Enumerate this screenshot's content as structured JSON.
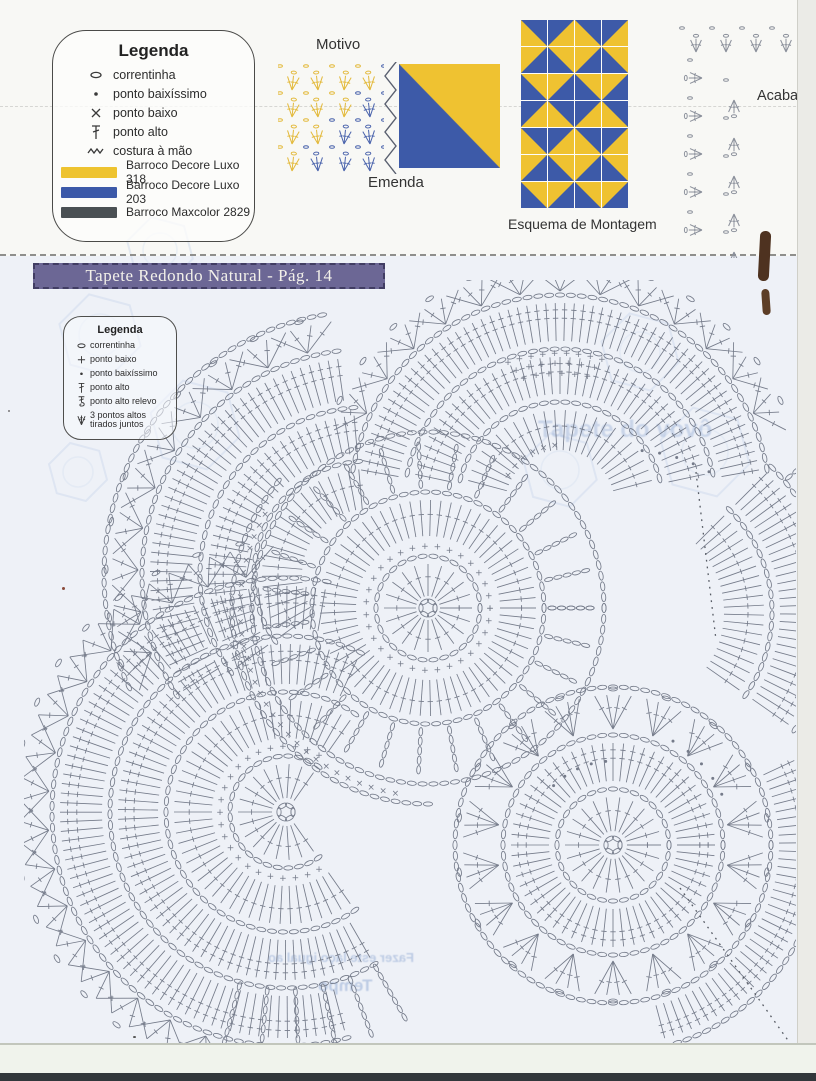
{
  "banner": {
    "title": "Tapete Redondo Natural - Pág. 14",
    "bg": "#6c6795"
  },
  "section_labels": {
    "motivo": "Motivo",
    "emenda": "Emenda",
    "esquema": "Esquema de Montagem",
    "acabamento": "Acabam"
  },
  "legend1": {
    "title": "Legenda",
    "items": [
      {
        "symbol": "chain",
        "label": "correntinha"
      },
      {
        "symbol": "slip-stitch",
        "label": "ponto baixíssimo"
      },
      {
        "symbol": "single-crochet-x",
        "label": "ponto baixo"
      },
      {
        "symbol": "double-crochet",
        "label": "ponto alto"
      },
      {
        "symbol": "hand-seam",
        "label": "costura à mão"
      }
    ],
    "yarns": [
      {
        "color": "#eec32f",
        "label": "Barroco Decore Luxo 318"
      },
      {
        "color": "#3c59a8",
        "label": "Barroco Decore Luxo 203"
      },
      {
        "color": "#4a5053",
        "label": "Barroco Maxcolor 2829"
      }
    ]
  },
  "legend2": {
    "title": "Legenda",
    "items": [
      {
        "symbol": "chain",
        "label": "correntinha"
      },
      {
        "symbol": "single-crochet-plus",
        "label": "ponto baixo"
      },
      {
        "symbol": "slip-stitch",
        "label": "ponto baixíssimo"
      },
      {
        "symbol": "double-crochet",
        "label": "ponto alto"
      },
      {
        "symbol": "double-crochet-relief",
        "label": "ponto alto relevo"
      },
      {
        "symbol": "3dc-together",
        "label": "3 pontos altos tirados juntos"
      }
    ]
  },
  "esquema": {
    "colors": {
      "yellow": "#efc231",
      "blue": "#3d5aa8"
    },
    "grid": [
      [
        "TR",
        "TL",
        "TR",
        "TL"
      ],
      [
        "BR",
        "BL",
        "BR",
        "BL"
      ],
      [
        "TRi",
        "TLi",
        "TRi",
        "TLi"
      ],
      [
        "BRi",
        "BLi",
        "BRi",
        "BLi"
      ],
      [
        "TR",
        "TL",
        "TR",
        "TL"
      ],
      [
        "BR",
        "BL",
        "BR",
        "BL"
      ],
      [
        "TRi",
        "TLi",
        "TRi",
        "TLi"
      ]
    ]
  },
  "motivo_chart": {
    "yellow": "#e3b93a",
    "blue": "#4a63ac",
    "rows": 4,
    "cols": 4
  },
  "emenda_square": {
    "top_right": "#efc231",
    "bottom_left": "#3d5aa8"
  },
  "ghost_texts": [
    {
      "text": "Tapete do vovô",
      "x": 538,
      "y": 416,
      "size": 24,
      "mirror": false,
      "opacity": 0.45
    },
    {
      "text": "Fazer este laço igual ao",
      "x": 268,
      "y": 950,
      "size": 13,
      "mirror": true,
      "opacity": 0.6
    },
    {
      "text": "Tempo",
      "x": 318,
      "y": 976,
      "size": 17,
      "mirror": true,
      "opacity": 0.6
    }
  ],
  "diagram": {
    "stroke": "#6a7180",
    "circles": [
      {
        "name": "bottom-right",
        "cx": 613,
        "cy": 845,
        "rings": [
          {
            "t": "ovals",
            "r": 7
          },
          {
            "t": "spokes",
            "r0": 14,
            "r1": 48,
            "ticks": 1
          },
          {
            "t": "ovals",
            "r": 56
          },
          {
            "t": "spokes",
            "r0": 64,
            "r1": 102,
            "ticks": 2
          },
          {
            "t": "ovals",
            "r": 110
          },
          {
            "t": "shells",
            "r0": 118,
            "r1": 150
          },
          {
            "t": "ovals",
            "r": 158
          },
          {
            "t": "spokes",
            "r0": 166,
            "r1": 200,
            "a0": -75,
            "a1": 25,
            "ticks": 2
          },
          {
            "t": "ovals",
            "r": 208,
            "a0": -75,
            "a1": 25
          },
          {
            "t": "dots",
            "r": 120,
            "a0": 25,
            "a1": 60
          },
          {
            "t": "dots",
            "r": 84,
            "a0": 95,
            "a1": 135
          }
        ]
      },
      {
        "name": "bottom-left",
        "cx": 286,
        "cy": 812,
        "rings": [
          {
            "t": "ovals",
            "r": 7
          },
          {
            "t": "spokes",
            "r0": 14,
            "r1": 48,
            "a0": 55,
            "a1": 305,
            "ticks": 1
          },
          {
            "t": "ovals",
            "r": 56,
            "a0": 55,
            "a1": 305
          },
          {
            "t": "plus",
            "r": 66,
            "a0": 60,
            "a1": 300
          },
          {
            "t": "spokes",
            "r0": 74,
            "r1": 112,
            "a0": 55,
            "a1": 305,
            "ticks": 1
          },
          {
            "t": "ovals",
            "r": 120,
            "a0": 55,
            "a1": 305
          },
          {
            "t": "spokes",
            "r0": 128,
            "r1": 168,
            "a0": 65,
            "a1": 300,
            "ticks": 2
          },
          {
            "t": "ovals",
            "r": 176,
            "a0": 65,
            "a1": 300
          },
          {
            "t": "spokes",
            "r0": 184,
            "r1": 226,
            "a0": 80,
            "a1": 285,
            "ticks": 2
          },
          {
            "t": "ovals",
            "r": 234,
            "a0": 80,
            "a1": 285
          },
          {
            "t": "shells",
            "r0": 240,
            "r1": 266,
            "a0": 95,
            "a1": 255
          },
          {
            "t": "chains",
            "r0": 180,
            "r1": 246,
            "a0": 255,
            "a1": 300
          }
        ]
      },
      {
        "name": "middle",
        "cx": 428,
        "cy": 608,
        "rings": [
          {
            "t": "ovals",
            "r": 7
          },
          {
            "t": "spokes",
            "r0": 12,
            "r1": 44,
            "ticks": 1
          },
          {
            "t": "ovals",
            "r": 52
          },
          {
            "t": "plus",
            "r": 62
          },
          {
            "t": "spokes",
            "r0": 72,
            "r1": 108,
            "ticks": 1
          },
          {
            "t": "ovals",
            "r": 116
          },
          {
            "t": "chains",
            "r0": 124,
            "r1": 168
          },
          {
            "t": "ovals",
            "r": 176
          },
          {
            "t": "x",
            "r": 188,
            "a0": 150,
            "a1": 260
          },
          {
            "t": "ovals",
            "r": 196,
            "a0": 140,
            "a1": 270
          }
        ]
      },
      {
        "name": "top",
        "cx": 560,
        "cy": 505,
        "rings": [
          {
            "t": "x",
            "r": 60,
            "a0": 95,
            "a1": 150
          },
          {
            "t": "spokes",
            "r0": 55,
            "r1": 95,
            "a0": 15,
            "a1": 165,
            "ticks": 1
          },
          {
            "t": "ovals",
            "r": 103,
            "a0": 15,
            "a1": 165
          },
          {
            "t": "spokes",
            "r0": 111,
            "r1": 148,
            "a0": 12,
            "a1": 168,
            "ticks": 2
          },
          {
            "t": "ovals",
            "r": 156,
            "a0": 12,
            "a1": 168
          },
          {
            "t": "plus",
            "r": 132,
            "a0": 78,
            "a1": 106
          },
          {
            "t": "plus",
            "r": 142,
            "a0": 76,
            "a1": 108
          },
          {
            "t": "plus",
            "r": 152,
            "a0": 74,
            "a1": 110
          },
          {
            "t": "spokes",
            "r0": 164,
            "r1": 202,
            "a0": 10,
            "a1": 170,
            "ticks": 2
          },
          {
            "t": "ovals",
            "r": 210,
            "a0": 10,
            "a1": 170
          },
          {
            "t": "shells",
            "r0": 216,
            "r1": 238,
            "a0": 20,
            "a1": 160
          }
        ]
      },
      {
        "name": "top-left",
        "cx": 368,
        "cy": 575,
        "rings": [
          {
            "t": "spokes",
            "r0": 66,
            "r1": 106,
            "a0": 95,
            "a1": 215,
            "ticks": 1
          },
          {
            "t": "ovals",
            "r": 114,
            "a0": 95,
            "a1": 215
          },
          {
            "t": "spokes",
            "r0": 122,
            "r1": 160,
            "a0": 95,
            "a1": 215,
            "ticks": 2
          },
          {
            "t": "ovals",
            "r": 168,
            "a0": 95,
            "a1": 215
          },
          {
            "t": "spokes",
            "r0": 176,
            "r1": 218,
            "a0": 98,
            "a1": 212,
            "ticks": 2
          },
          {
            "t": "ovals",
            "r": 226,
            "a0": 98,
            "a1": 212
          },
          {
            "t": "shells",
            "r0": 232,
            "r1": 256,
            "a0": 100,
            "a1": 205
          },
          {
            "t": "ovals",
            "r": 264,
            "a0": 100,
            "a1": 205
          }
        ]
      },
      {
        "name": "right",
        "cx": 628,
        "cy": 612,
        "rings": [
          {
            "t": "spokes",
            "r0": 96,
            "r1": 136,
            "a0": -35,
            "a1": 45,
            "ticks": 1
          },
          {
            "t": "ovals",
            "r": 144,
            "a0": -35,
            "a1": 45
          },
          {
            "t": "spokes",
            "r0": 152,
            "r1": 196,
            "a0": -35,
            "a1": 45,
            "ticks": 2
          },
          {
            "t": "ovals",
            "r": 204,
            "a0": -35,
            "a1": 45
          },
          {
            "t": "chains",
            "r0": 210,
            "r1": 254,
            "a0": -30,
            "a1": 40
          },
          {
            "t": "dots",
            "r": 162,
            "a0": 60,
            "a1": 85
          }
        ]
      }
    ],
    "seams": [
      {
        "x1": 680,
        "y1": 888,
        "x2": 792,
        "y2": 1046
      },
      {
        "x1": 696,
        "y1": 472,
        "x2": 716,
        "y2": 640
      }
    ]
  },
  "ghost_shapes": [
    {
      "x": 100,
      "y": 335,
      "r": 42
    },
    {
      "x": 195,
      "y": 425,
      "r": 46
    },
    {
      "x": 78,
      "y": 472,
      "r": 30
    },
    {
      "x": 640,
      "y": 352,
      "r": 40
    },
    {
      "x": 705,
      "y": 452,
      "r": 46
    },
    {
      "x": 160,
      "y": 250,
      "r": 34
    },
    {
      "x": 560,
      "y": 470,
      "r": 38
    }
  ]
}
